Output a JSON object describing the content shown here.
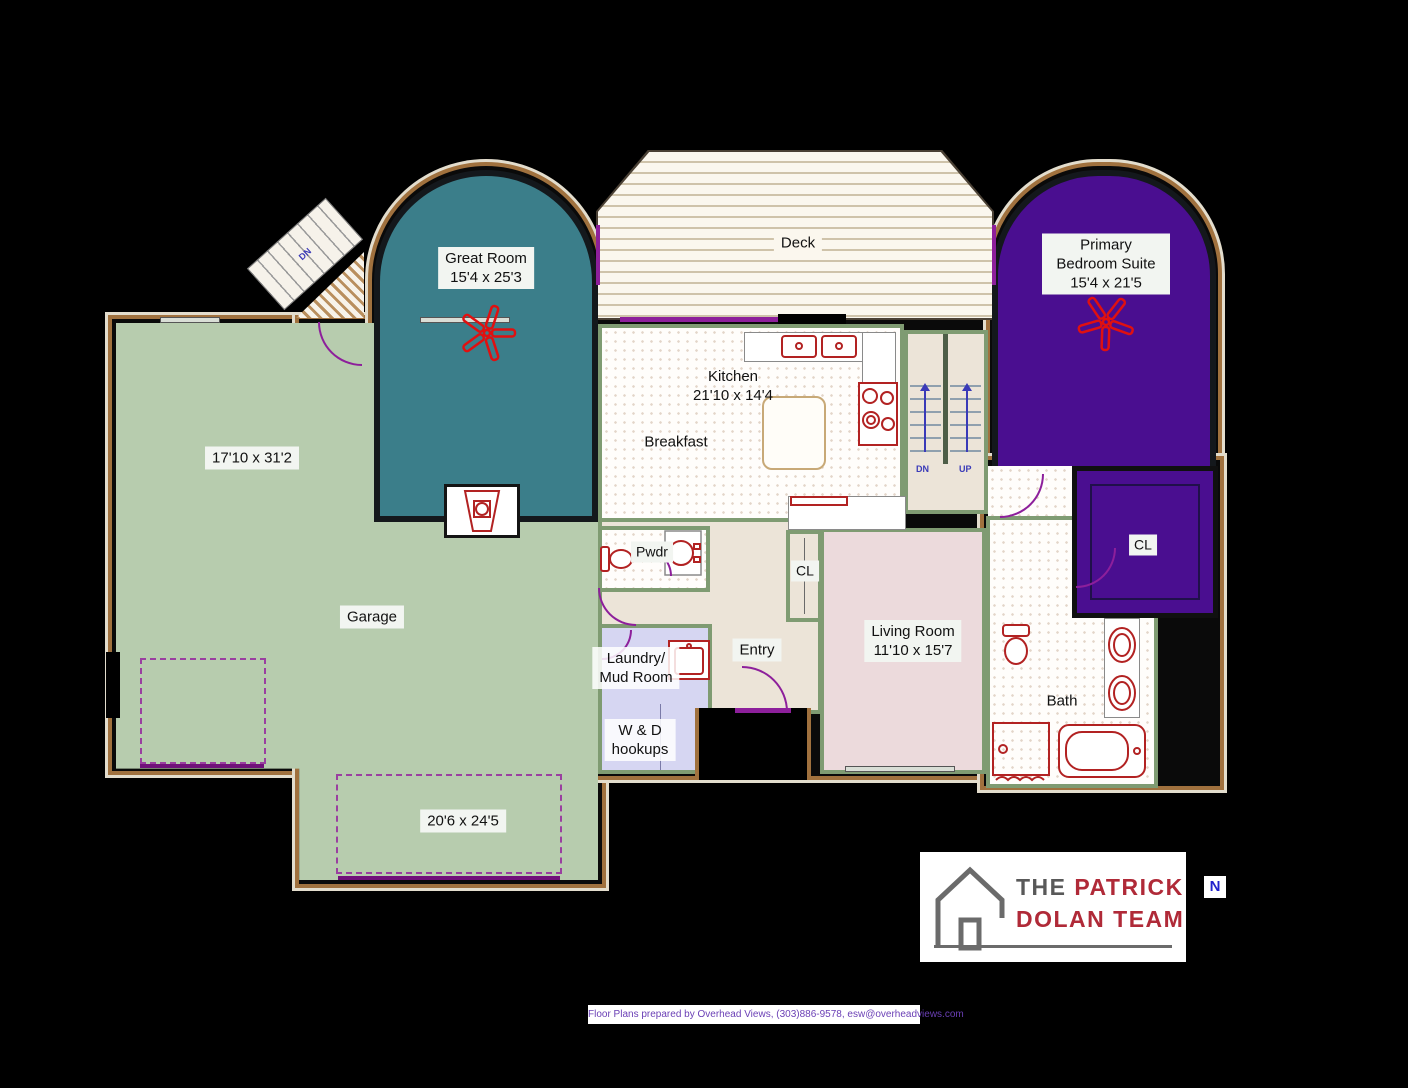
{
  "floor_plan": {
    "rooms": {
      "great_room": {
        "name": "Great Room",
        "dims": "15'4 x 25'3"
      },
      "deck": {
        "name": "Deck"
      },
      "primary_bedroom": {
        "name": "Primary Bedroom Suite",
        "dims": "15'4 x 21'5"
      },
      "garage": {
        "name": "Garage",
        "dims_main": "17'10 x 31'2",
        "dims_bay": "20'6 x 24'5"
      },
      "kitchen": {
        "name": "Kitchen",
        "dims": "21'10 x 14'4"
      },
      "breakfast": {
        "name": "Breakfast"
      },
      "powder_room": {
        "name": "Pwdr"
      },
      "hall_closet": {
        "name": "CL"
      },
      "laundry": {
        "name_line1": "Laundry/",
        "name_line2": "Mud Room",
        "note_line1": "W & D",
        "note_line2": "hookups"
      },
      "entry": {
        "name": "Entry"
      },
      "living_room": {
        "name": "Living Room",
        "dims": "11'10 x 15'7"
      },
      "bath": {
        "name": "Bath"
      },
      "primary_closet": {
        "name": "CL"
      }
    },
    "stairs": {
      "down": "DN",
      "up": "UP",
      "exterior_down": "DN"
    },
    "compass": {
      "north": "N"
    }
  },
  "branding": {
    "logo": {
      "the": "THE",
      "patrick": "PATRICK",
      "dolan_team": "DOLAN TEAM"
    }
  },
  "footer": {
    "credit": "Floor Plans prepared by Overhead Views, (303)886-9578, esw@overheadviews.com"
  },
  "colors": {
    "great_room": "#3b7e8a",
    "primary_bedroom": "#4a0e90",
    "garage": "#b7ccae",
    "living_room": "#ecdadc",
    "laundry": "#d6d6f2",
    "hall": "#ece4d8",
    "wall_olive": "#7f9b72",
    "wall_brown": "#a0713e",
    "fixture_red": "#b22222",
    "fan_red": "#e01010",
    "arrow_blue": "#3a3ab8",
    "door_purple": "#8d1f9b",
    "logo_red": "#b02a38",
    "logo_gray": "#595959",
    "footer_text": "#6a3fb5"
  }
}
